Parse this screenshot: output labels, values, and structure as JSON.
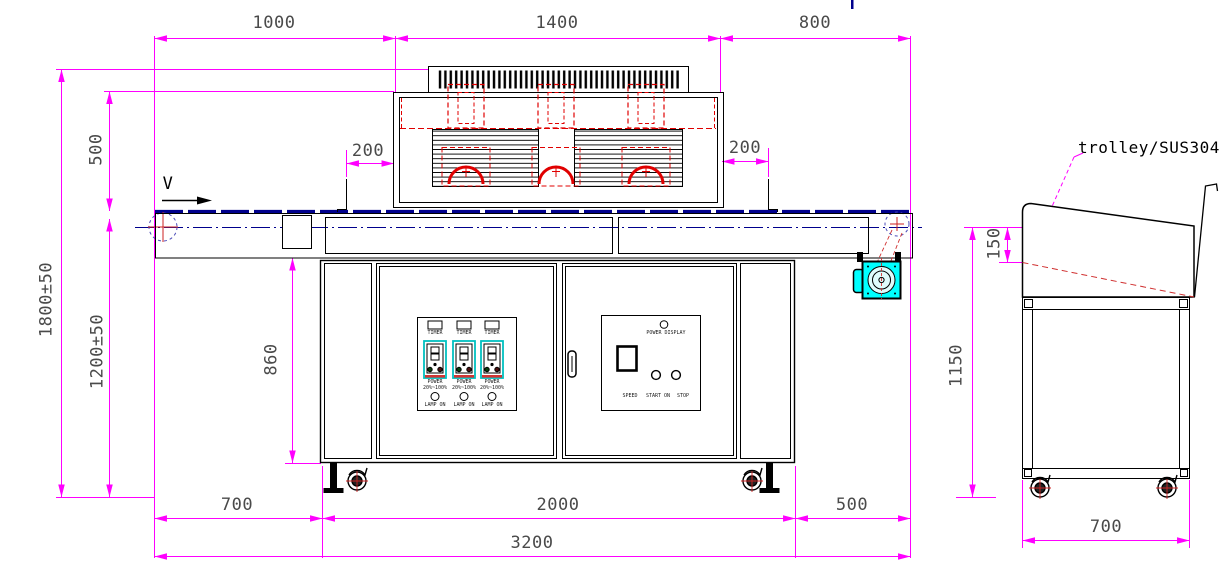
{
  "title": "UV curing machine technical drawing",
  "front_view": {
    "direction_label": "V",
    "dim_top_left": "1000",
    "dim_top_mid": "1400",
    "dim_top_right": "800",
    "dim_lamp_left": "200",
    "dim_lamp_right": "200",
    "dim_housing_to_belt": "500",
    "dim_total_height": "1800±50",
    "dim_belt_height": "1200±50",
    "dim_cabinet_height": "860",
    "dim_bottom_left": "700",
    "dim_cabinet_width": "2000",
    "dim_bottom_right": "500",
    "dim_total_length": "3200",
    "panel_left": {
      "channels": [
        {
          "timer": "TIMER",
          "power": "POWER",
          "range": "20%~100%",
          "lamp": "LAMP ON"
        },
        {
          "timer": "TIMER",
          "power": "POWER",
          "range": "20%~100%",
          "lamp": "LAMP ON"
        },
        {
          "timer": "TIMER",
          "power": "POWER",
          "range": "20%~100%",
          "lamp": "LAMP ON"
        }
      ]
    },
    "panel_right": {
      "power_display": "POWER DISPLAY",
      "speed": "SPEED",
      "start": "START ON",
      "stop": "STOP"
    }
  },
  "trolley_view": {
    "label": "trolley/SUS304",
    "dim_tray_depth": "150",
    "dim_height": "1150",
    "dim_width": "700"
  },
  "colors": {
    "dimension": "#ff00ff",
    "outline": "#000000",
    "detail_red": "#e00000",
    "fill_cyan": "#00ffff",
    "belt_navy": "#00008b"
  }
}
